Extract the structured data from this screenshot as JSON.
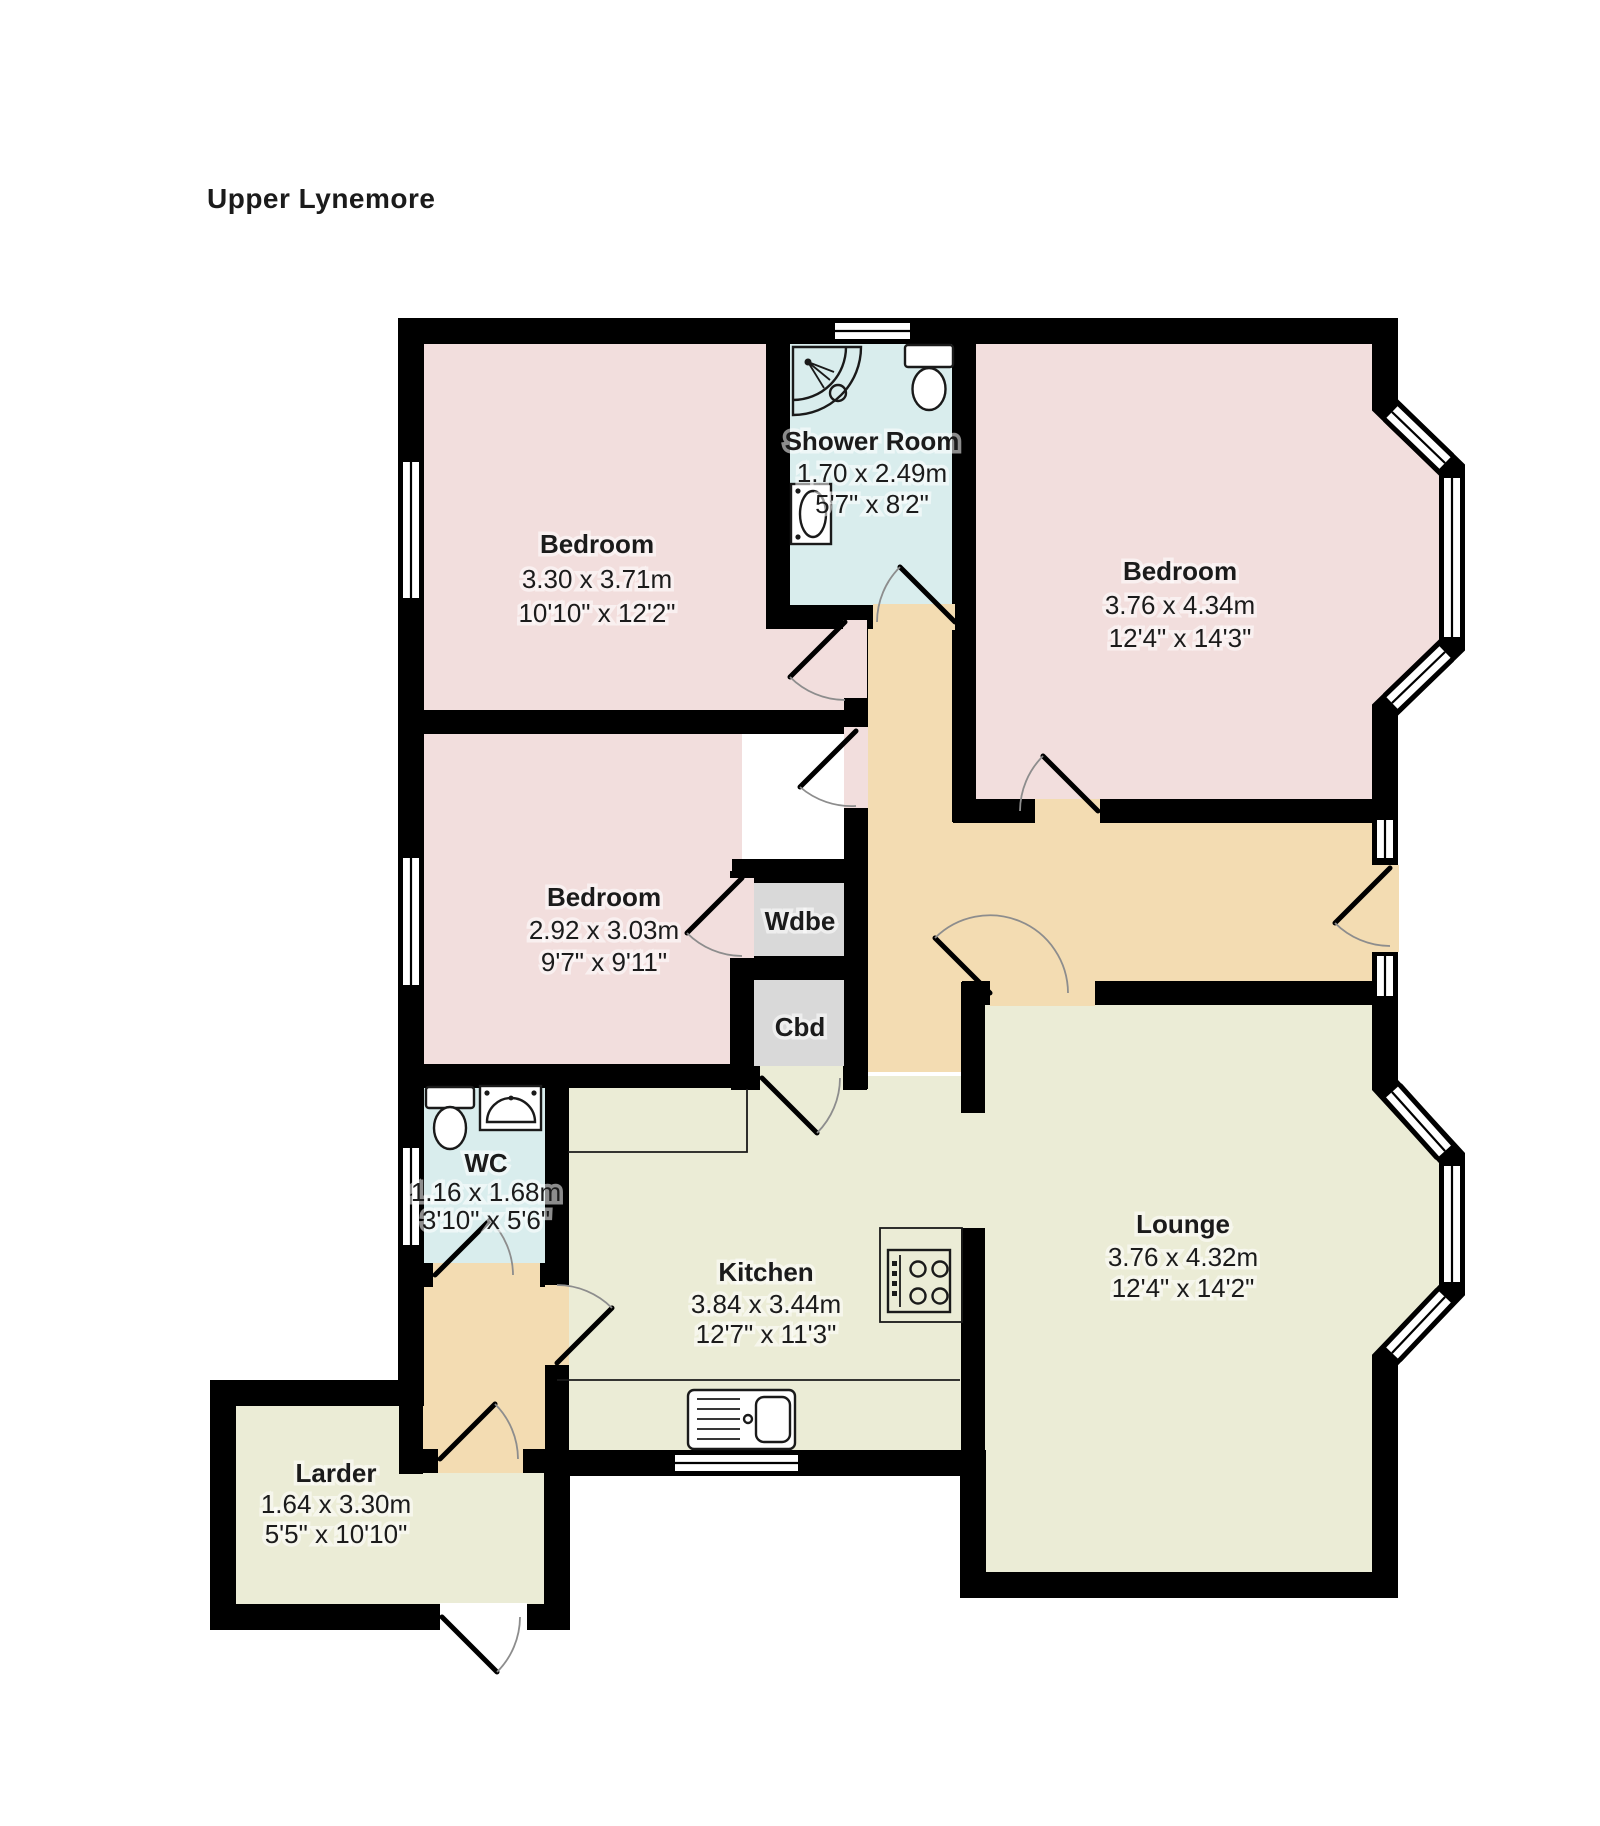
{
  "title": "Upper Lynemore",
  "rooms": [
    {
      "id": "bedroom-1",
      "name": "Bedroom",
      "metric": "3.30 x 3.71m",
      "imperial": "10'10\" x 12'2\""
    },
    {
      "id": "shower-room",
      "name": "Shower Room",
      "metric": "1.70 x 2.49m",
      "imperial": "5'7\" x 8'2\""
    },
    {
      "id": "bedroom-2",
      "name": "Bedroom",
      "metric": "3.76 x 4.34m",
      "imperial": "12'4\" x 14'3\""
    },
    {
      "id": "bedroom-3",
      "name": "Bedroom",
      "metric": "2.92 x 3.03m",
      "imperial": "9'7\" x 9'11\""
    },
    {
      "id": "wardrobe",
      "name": "Wdbe",
      "metric": "",
      "imperial": ""
    },
    {
      "id": "cupboard",
      "name": "Cbd",
      "metric": "",
      "imperial": ""
    },
    {
      "id": "wc",
      "name": "WC",
      "metric": "1.16 x 1.68m",
      "imperial": "3'10\" x 5'6\""
    },
    {
      "id": "kitchen",
      "name": "Kitchen",
      "metric": "3.84 x 3.44m",
      "imperial": "12'7\" x 11'3\""
    },
    {
      "id": "lounge",
      "name": "Lounge",
      "metric": "3.76 x 4.32m",
      "imperial": "12'4\" x 14'2\""
    },
    {
      "id": "larder",
      "name": "Larder",
      "metric": "1.64 x 3.30m",
      "imperial": "5'5\" x 10'10\""
    }
  ],
  "colors": {
    "bedroom": "#f2dedd",
    "bathroom": "#d9eded",
    "living": "#ebecd6",
    "hall": "#f3dcb2",
    "cupboard": "#d9d9d9",
    "wall": "#000000"
  }
}
